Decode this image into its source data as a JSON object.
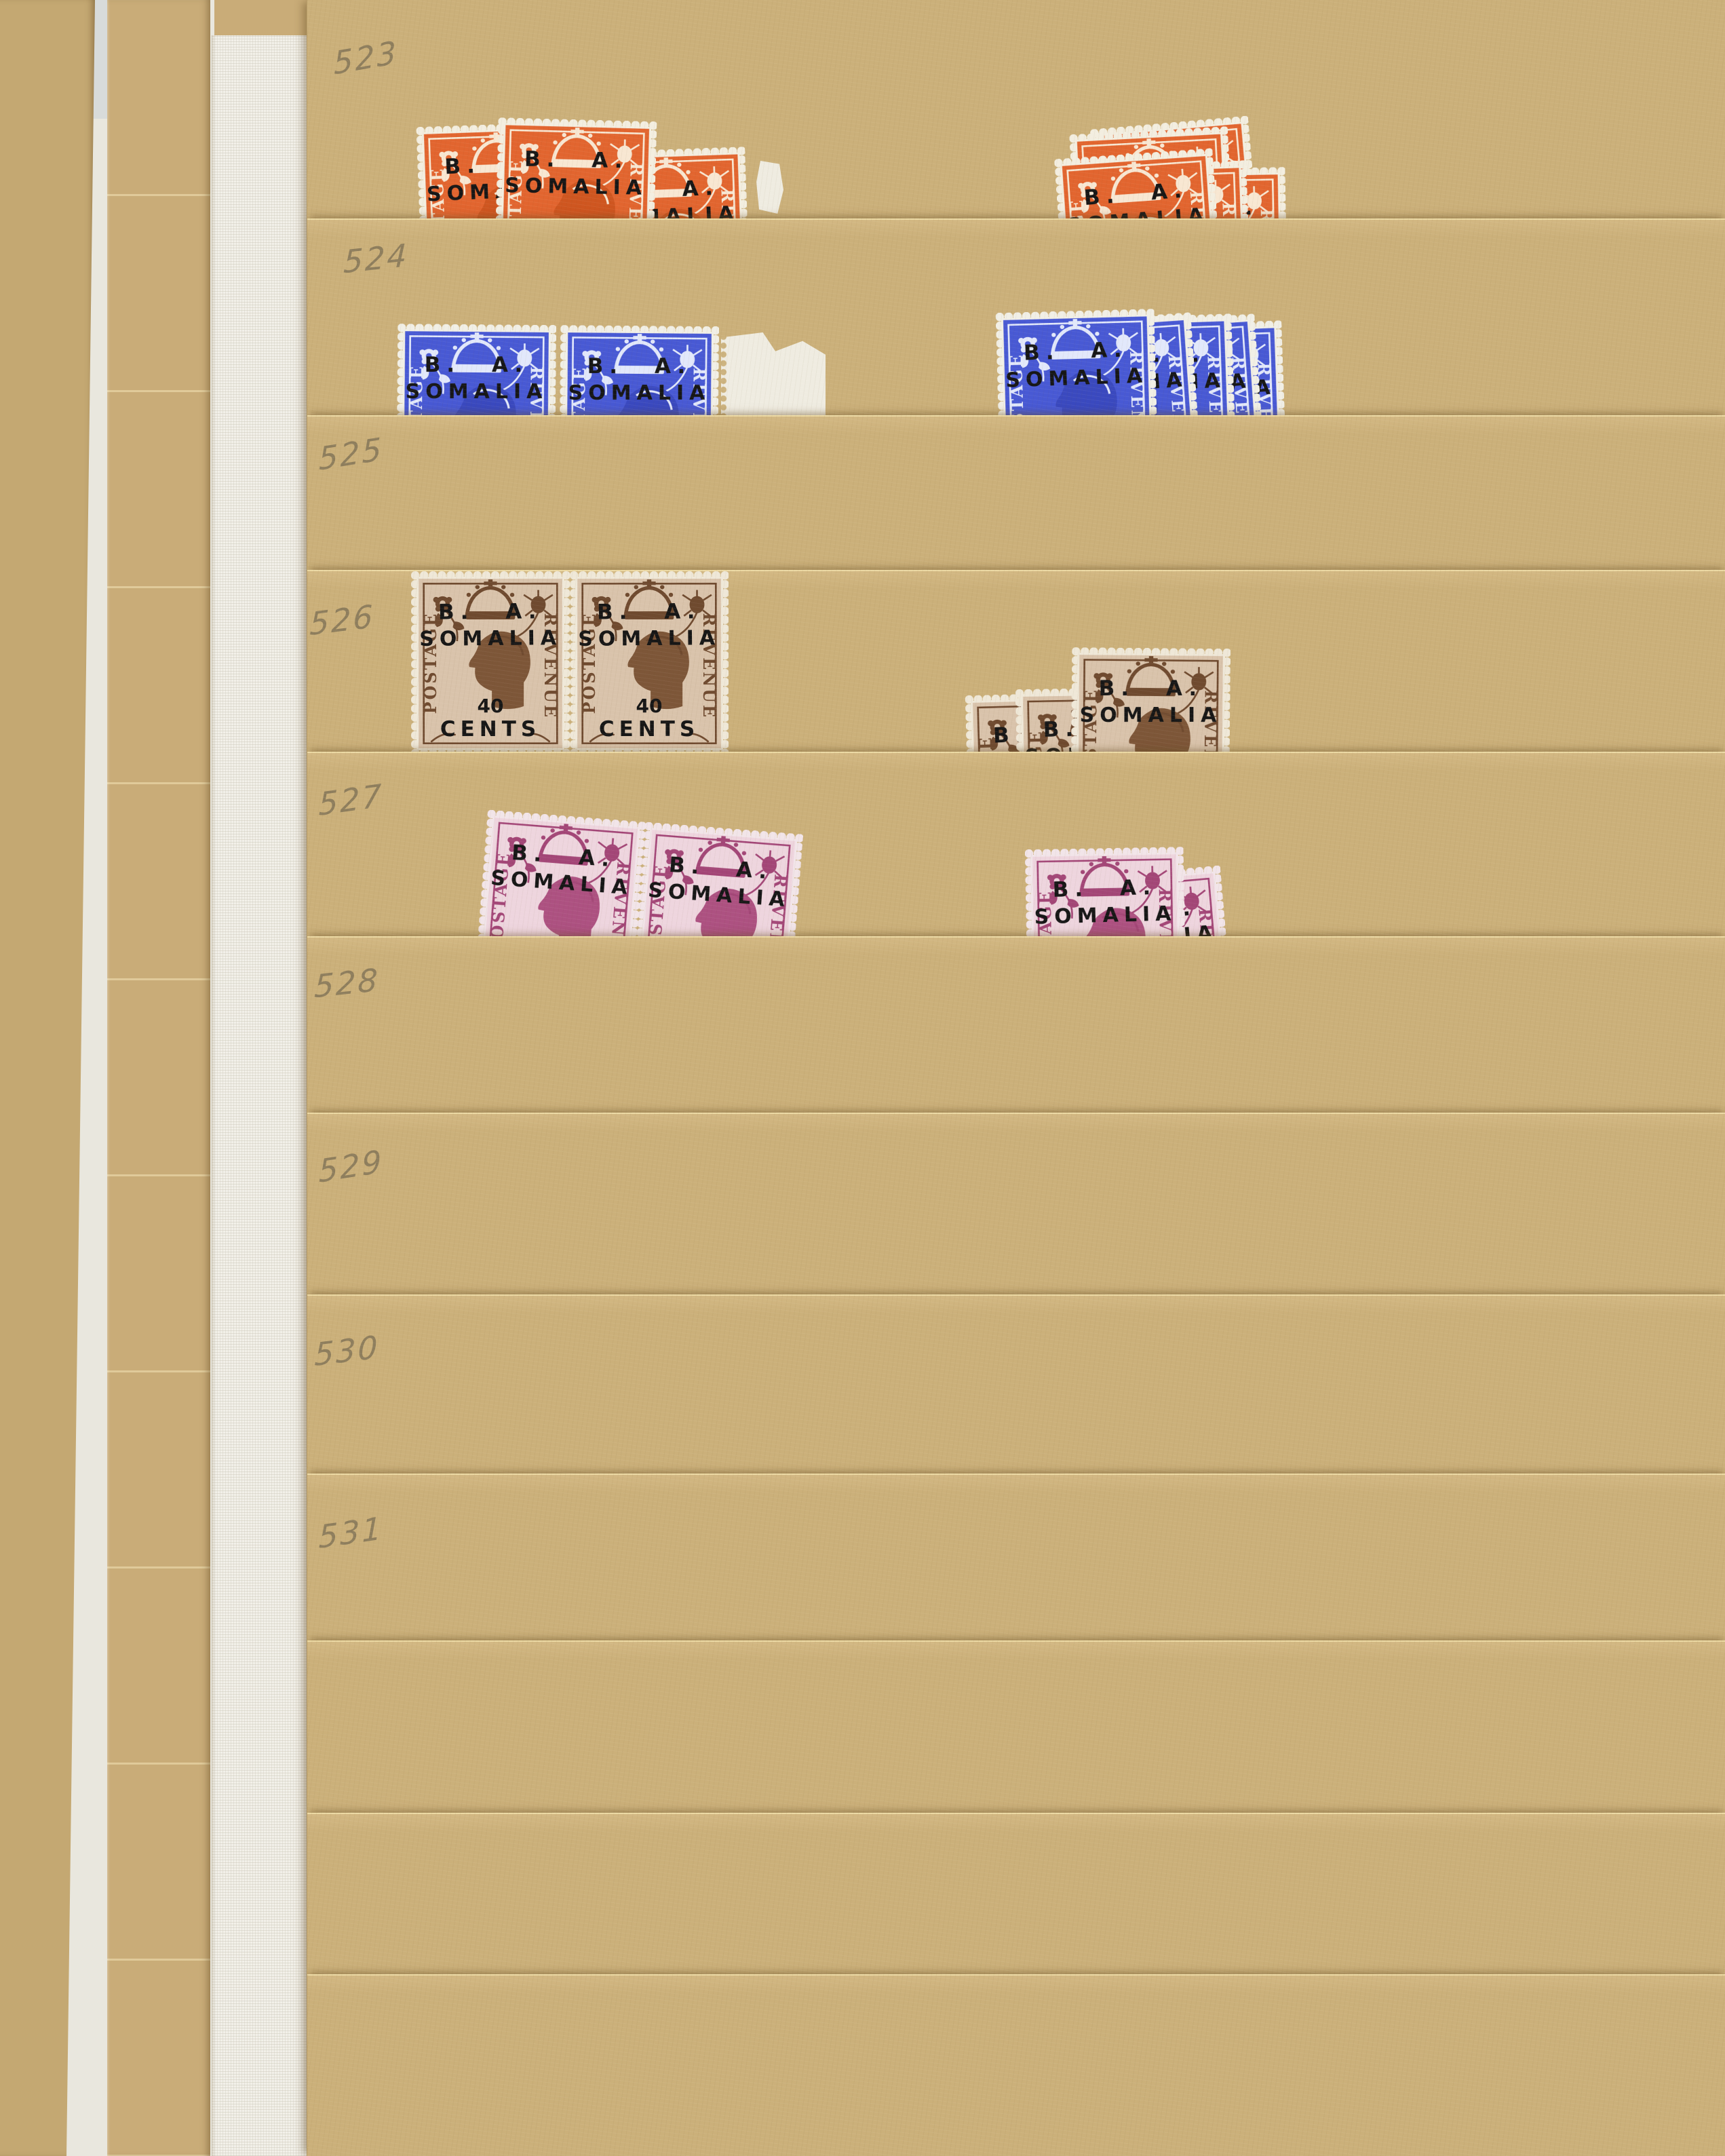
{
  "page": {
    "row_labels": [
      "523",
      "524",
      "525",
      "526",
      "527",
      "528",
      "529",
      "530",
      "531"
    ]
  },
  "stamps": {
    "overprint_line1": "B. A.",
    "overprint_line2": "SOMALIA",
    "surcharge_line1": "40",
    "surcharge_line2": "CENTS",
    "word_left": "POSTAGE",
    "word_right": "REVENUE",
    "colors": {
      "orange": "#e2652f",
      "blue": "#4859d4",
      "brown_ink": "#6f4a2f",
      "brown_paper": "#d9c3ab",
      "purple_ink": "#a34677",
      "purple_paper": "#eed5de",
      "overprint": "#161616",
      "stamp_paper": "#f3eee0"
    },
    "rows": [
      {
        "label": "523",
        "color_name": "orange",
        "left_group_count": 3,
        "right_group_count": 5,
        "extra": "torn white paper fragment"
      },
      {
        "label": "524",
        "color_name": "blue",
        "left_group_count": 2,
        "right_group_count": 5,
        "extra": "white sheet-margin selvage"
      },
      {
        "label": "525",
        "color_name": "",
        "left_group_count": 0,
        "right_group_count": 0,
        "extra": ""
      },
      {
        "label": "526",
        "color_name": "brown",
        "left_group_count": 2,
        "right_group_count": 3,
        "extra": ""
      },
      {
        "label": "527",
        "color_name": "purple",
        "left_group_count": 2,
        "right_group_count": 2,
        "extra": ""
      },
      {
        "label": "528",
        "color_name": "",
        "left_group_count": 0,
        "right_group_count": 0,
        "extra": ""
      },
      {
        "label": "529",
        "color_name": "",
        "left_group_count": 0,
        "right_group_count": 0,
        "extra": ""
      },
      {
        "label": "530",
        "color_name": "",
        "left_group_count": 0,
        "right_group_count": 0,
        "extra": ""
      },
      {
        "label": "531",
        "color_name": "",
        "left_group_count": 0,
        "right_group_count": 0,
        "extra": ""
      }
    ]
  },
  "album": {
    "page_color": "#cbb07a",
    "edge_strip_color": "#c6a975",
    "linen_color": "#f1efe8"
  }
}
